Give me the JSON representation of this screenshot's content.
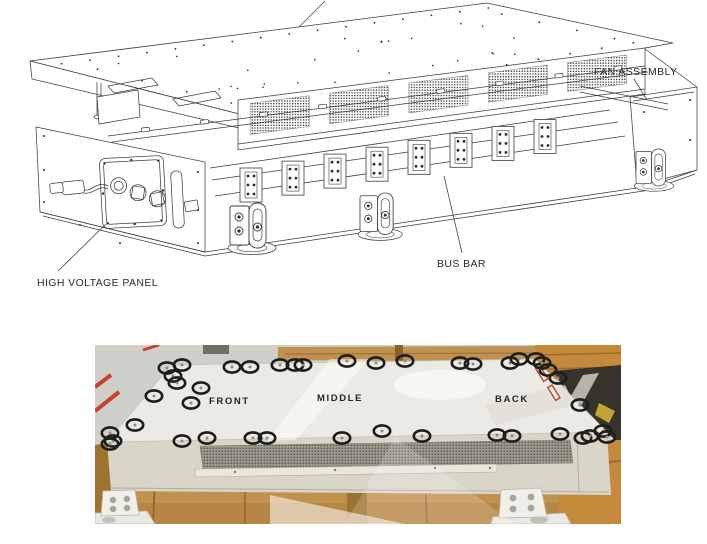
{
  "figure": {
    "top_diagram": {
      "kind": "exploded isometric line drawing of battery pack assembly",
      "labels": {
        "fan_assembly": "FAN ASSEMBLY",
        "bus_bar": "BUS BAR",
        "high_voltage_panel": "HIGH VOLTAGE PANEL"
      }
    },
    "photo": {
      "kind": "photograph of assembled pack on wooden pallet with fastener locations circled",
      "section_labels": {
        "front": "FRONT",
        "middle": "MIDDLE",
        "back": "BACK"
      },
      "fastener_marks": [
        [
          72,
          23
        ],
        [
          87,
          20
        ],
        [
          78,
          31
        ],
        [
          82,
          38
        ],
        [
          137,
          22
        ],
        [
          155,
          22
        ],
        [
          185,
          20
        ],
        [
          200,
          20
        ],
        [
          208,
          20
        ],
        [
          252,
          16
        ],
        [
          281,
          18
        ],
        [
          310,
          16
        ],
        [
          365,
          18
        ],
        [
          378,
          19
        ],
        [
          415,
          18
        ],
        [
          424,
          14
        ],
        [
          441,
          14
        ],
        [
          447,
          18
        ],
        [
          453,
          25
        ],
        [
          463,
          33
        ],
        [
          485,
          60
        ],
        [
          106,
          43
        ],
        [
          59,
          51
        ],
        [
          96,
          58
        ],
        [
          40,
          80
        ],
        [
          15,
          88
        ],
        [
          18,
          96
        ],
        [
          15,
          99
        ],
        [
          87,
          96
        ],
        [
          112,
          93
        ],
        [
          158,
          93
        ],
        [
          172,
          93
        ],
        [
          247,
          93
        ],
        [
          287,
          86
        ],
        [
          327,
          91
        ],
        [
          402,
          90
        ],
        [
          417,
          91
        ],
        [
          465,
          89
        ],
        [
          488,
          93
        ],
        [
          495,
          91
        ],
        [
          508,
          86
        ],
        [
          512,
          92
        ]
      ],
      "colors": {
        "floor": "#d1cfca",
        "wood": "#c0914f",
        "wood_dark": "#9d742f",
        "crate": "#c5893c",
        "enclosure_top": "#eceae4",
        "enclosure_front": "#d9d5c9",
        "vent_base": "#9b988c",
        "vent_dot": "#52504a",
        "mark": "#1d1d1b",
        "tape_red": "#c8402e",
        "line": "#3c3c3c"
      }
    }
  }
}
